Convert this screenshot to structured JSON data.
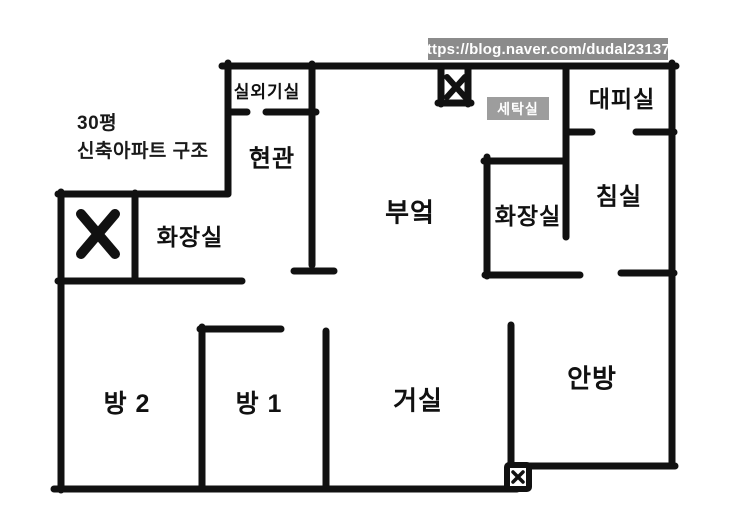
{
  "watermark": {
    "url_text": "https://blog.naver.com/dudal231379"
  },
  "annotation": {
    "line1": "30평",
    "line2": "신축아파트 구조"
  },
  "rooms": {
    "outdoor_unit_room": "실외기실",
    "entrance": "현관",
    "bathroom_left": "화장실",
    "kitchen": "부엌",
    "laundry_room": "세탁실",
    "shelter_room": "대피실",
    "bathroom_right": "화장실",
    "bedroom": "침실",
    "room_2": "방 2",
    "room_1": "방 1",
    "living_room": "거실",
    "master_bedroom": "안방"
  },
  "marks": {
    "blocked_x_left": "x-mark",
    "blocked_x_top": "x-mark",
    "small_x_bottom": "x-mark"
  },
  "colors": {
    "background": "#ffffff",
    "wall": "#111111",
    "url_badge_bg": "#8b8b8b",
    "laundry_badge_bg": "#9d9d9d",
    "badge_text": "#ffffff",
    "label_text": "#111111"
  }
}
